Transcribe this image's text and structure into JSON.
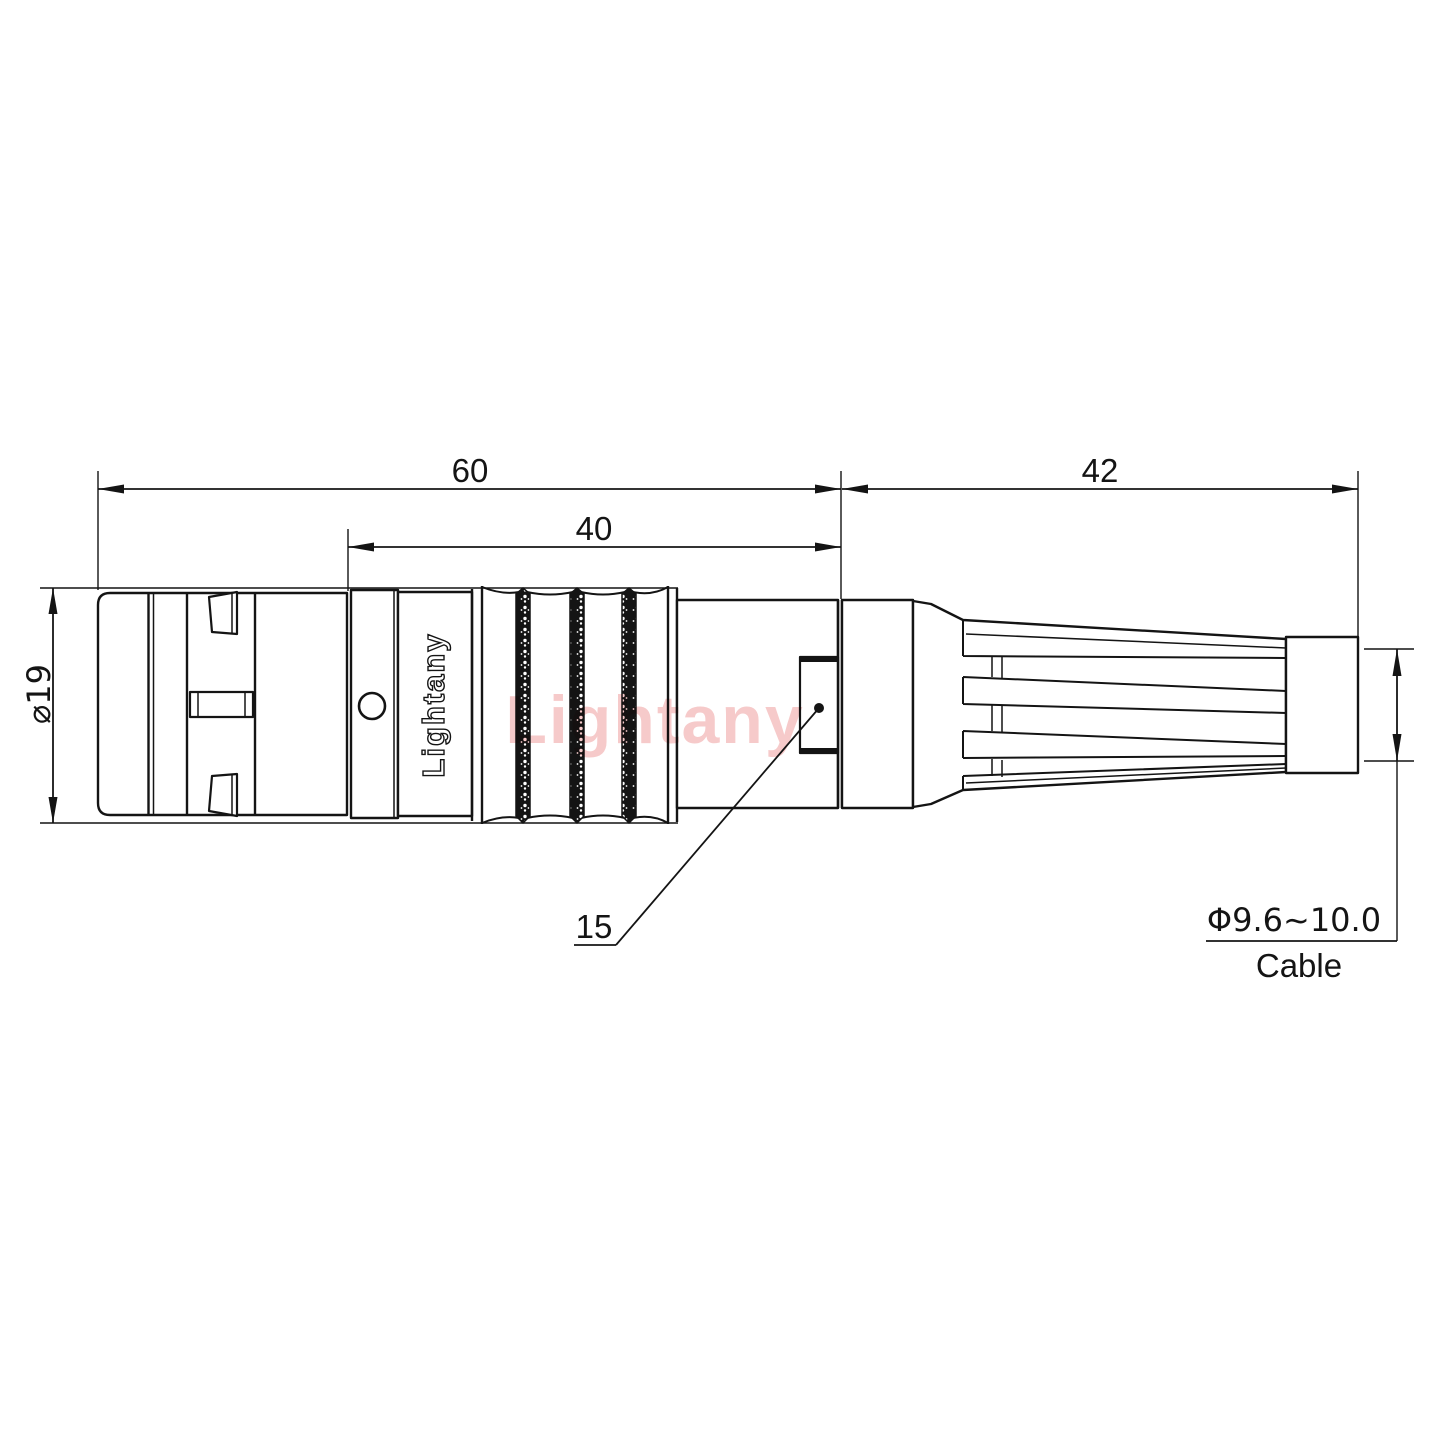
{
  "page": {
    "background": "#ffffff"
  },
  "drawing": {
    "dimensions": {
      "overall_length": "60",
      "grip_length": "40",
      "boot_length": "42",
      "shell_diameter": "⌀19",
      "rear_slot_width": "15",
      "cable_range": "Φ9.6~10.0",
      "cable_label": "Cable"
    },
    "branding": {
      "shell_marking": "Lightany",
      "watermark": "Lightany"
    },
    "colors": {
      "line": "#141414",
      "watermark_pink": "#f6caca",
      "background": "#ffffff"
    }
  }
}
